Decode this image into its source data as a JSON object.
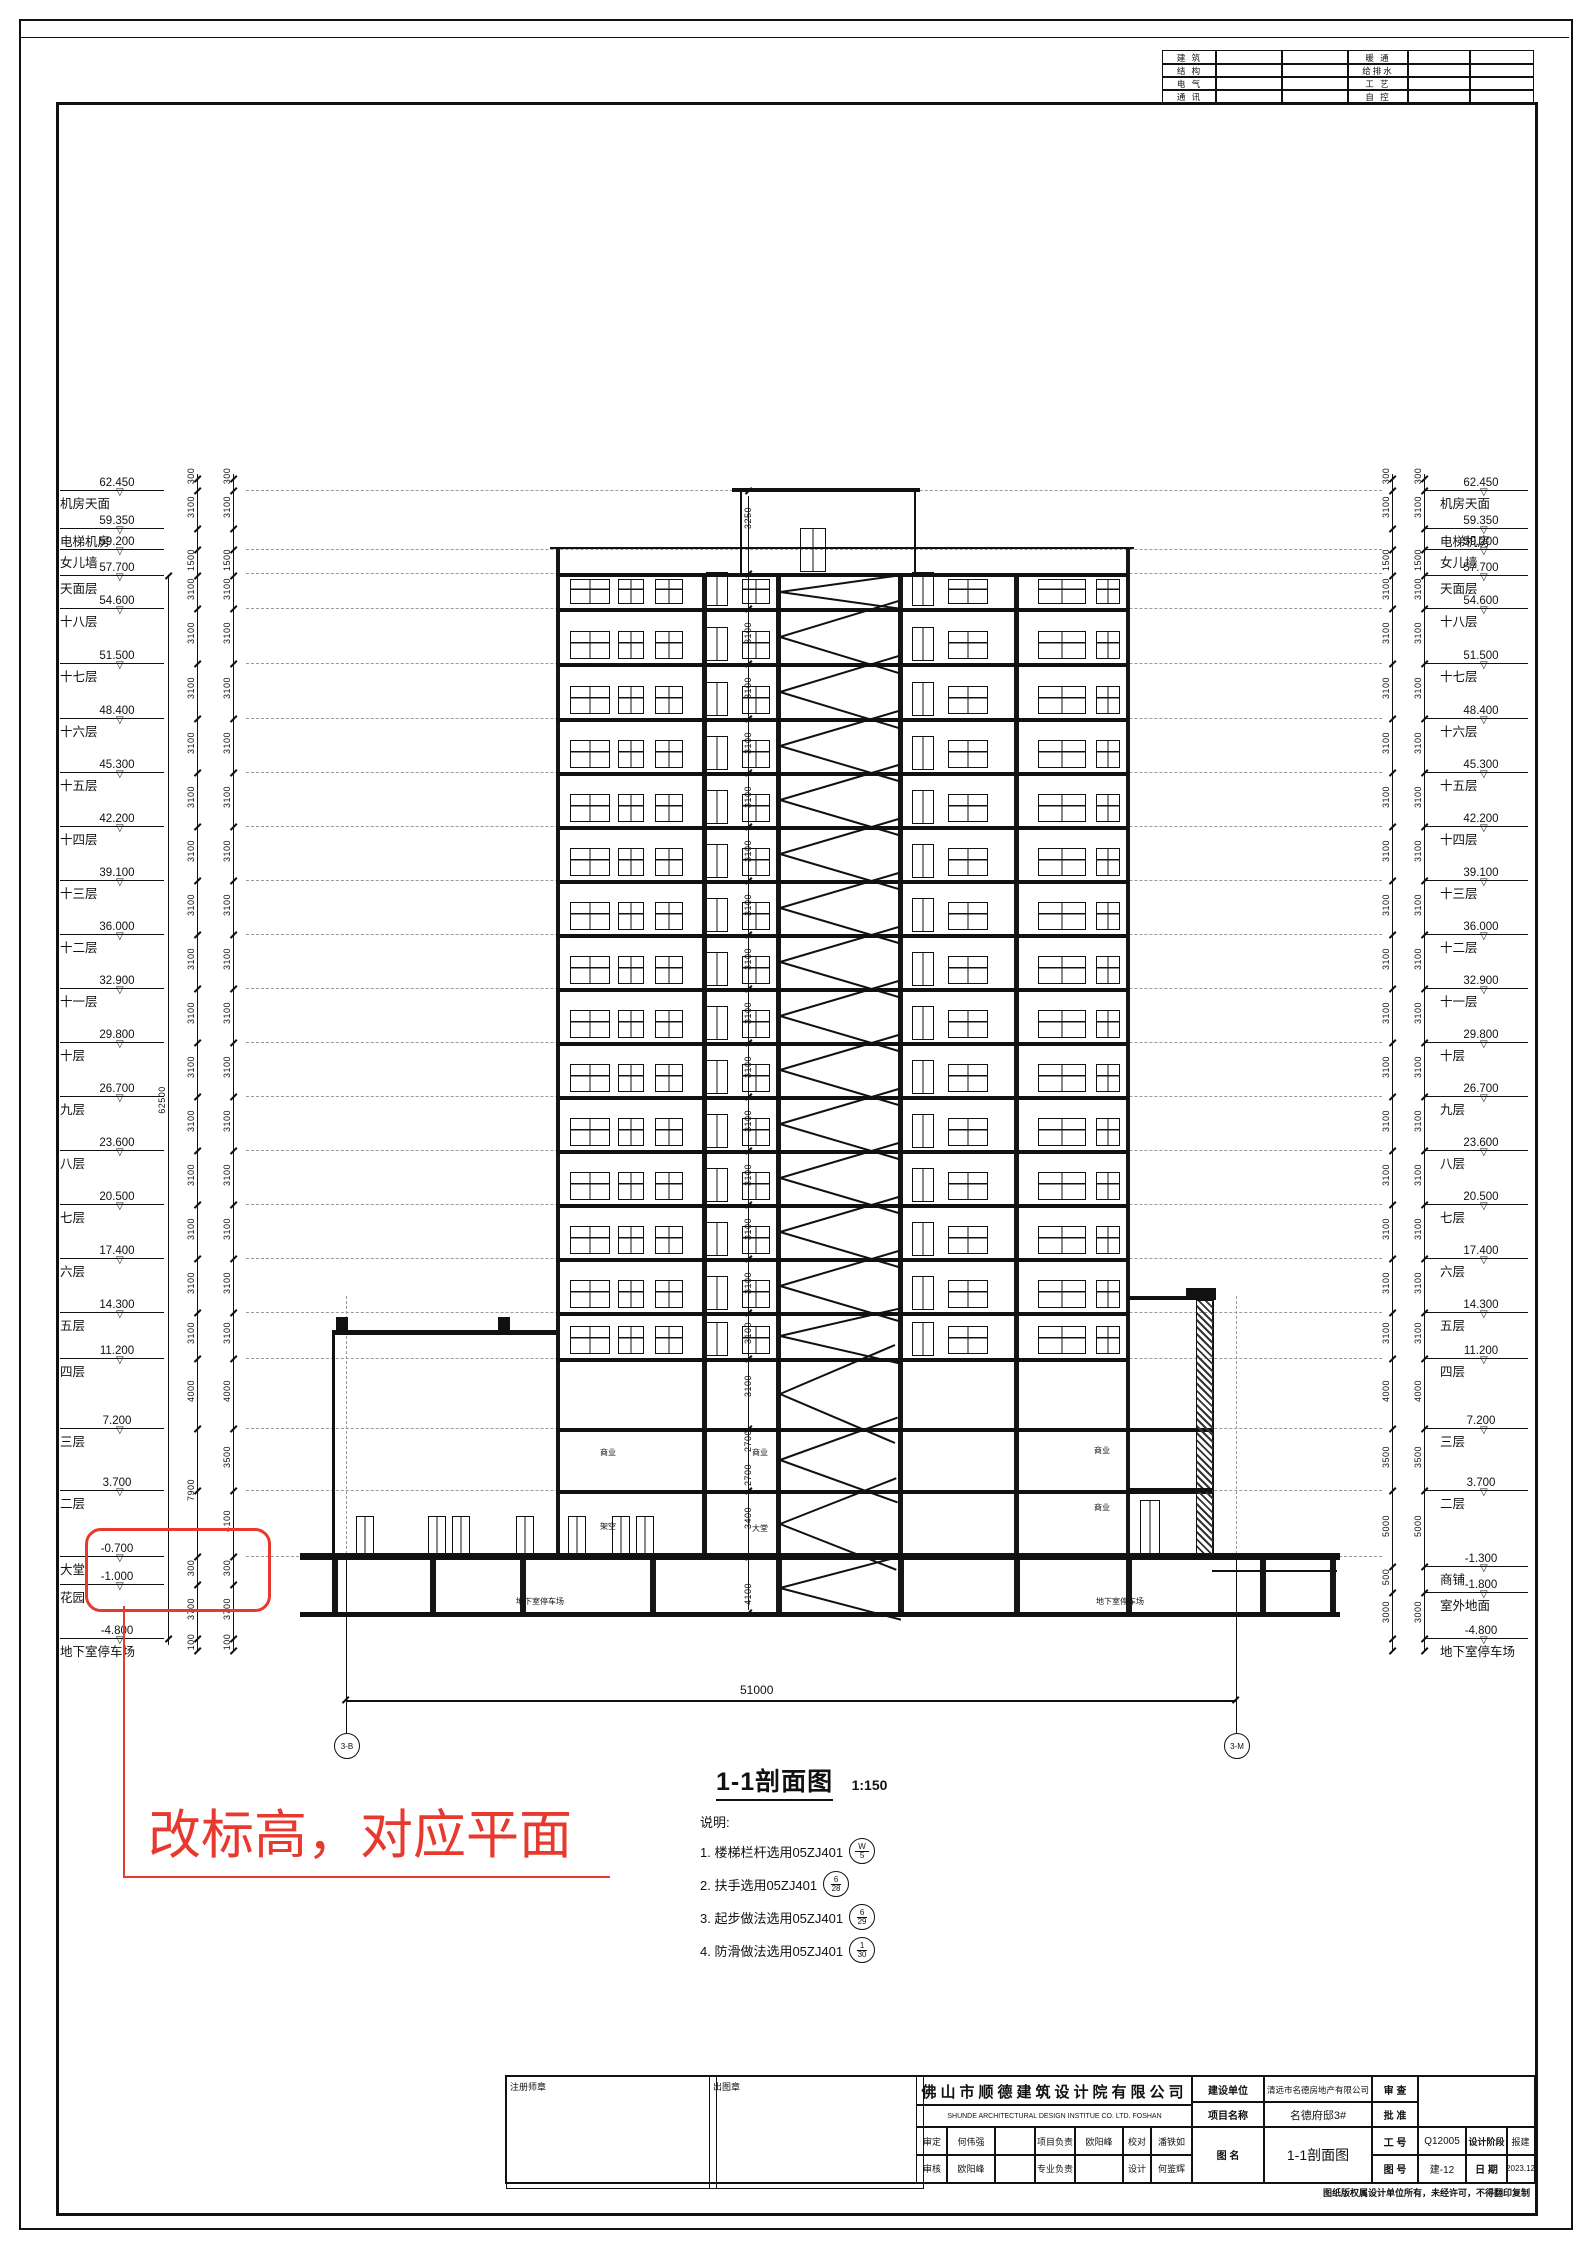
{
  "sheet": {
    "consultant_table": {
      "left_rows": [
        "建 筑",
        "结 构",
        "电 气",
        "通 讯"
      ],
      "right_rows": [
        "暖 通",
        "给排水",
        "工 艺",
        "自 控"
      ]
    },
    "caption": {
      "title": "1-1剖面图",
      "scale": "1:150"
    },
    "notes": {
      "heading": "说明:",
      "items": [
        {
          "text": "1. 楼梯栏杆选用05ZJ401",
          "num": "W",
          "den": "5"
        },
        {
          "text": "2. 扶手选用05ZJ401",
          "num": "6",
          "den": "28"
        },
        {
          "text": "3. 起步做法选用05ZJ401",
          "num": "6",
          "den": "29"
        },
        {
          "text": "4. 防滑做法选用05ZJ401",
          "num": "1",
          "den": "30"
        }
      ]
    },
    "revision": {
      "text": "改标高，对应平面",
      "color": "#e8392f"
    },
    "axes": {
      "dim_total": "51000",
      "left_bubble": "3-B",
      "right_bubble": "3-M"
    },
    "title_block": {
      "seal_left": "注册师章",
      "seal_right": "出图章",
      "company_cn": "佛山市顺德建筑设计院有限公司",
      "company_en": "SHUNDE  ARCHITECTURAL  DESIGN  INSTITUE  CO. LTD.   FOSHAN",
      "row1": [
        "审定",
        "何伟强",
        "",
        "项目负责",
        "欧阳峰",
        "校对",
        "潘铁如"
      ],
      "row2": [
        "审核",
        "欧阳峰",
        "",
        "专业负责",
        "",
        "设计",
        "何鉴辉"
      ],
      "client_label": "建设单位",
      "client": "清远市名德房地产有限公司",
      "project_label": "项目名称",
      "project": "名德府邸3#",
      "drawing_label": "图 名",
      "drawing_title": "1-1剖面图",
      "review_label": "审 查",
      "approve_label": "批 准",
      "job_label": "工 号",
      "job_no": "Q12005",
      "stage_label": "设计阶段",
      "stage": "报建",
      "sheet_label": "图 号",
      "sheet_no": "建-12",
      "date_label": "日 期",
      "date": "2023.12",
      "copyright": "图纸版权属设计单位所有，未经许可，不得翻印复制"
    }
  },
  "levels": {
    "left": [
      {
        "name": "机房天面",
        "elev": "62.450",
        "y": 490
      },
      {
        "name": "电梯机房",
        "elev": "59.350",
        "y": 528
      },
      {
        "name": "女儿墙",
        "elev": "59.200",
        "y": 549
      },
      {
        "name": "天面层",
        "elev": "57.700",
        "y": 575
      },
      {
        "name": "十八层",
        "elev": "54.600",
        "y": 608
      },
      {
        "name": "十七层",
        "elev": "51.500",
        "y": 663
      },
      {
        "name": "十六层",
        "elev": "48.400",
        "y": 718
      },
      {
        "name": "十五层",
        "elev": "45.300",
        "y": 772
      },
      {
        "name": "十四层",
        "elev": "42.200",
        "y": 826
      },
      {
        "name": "十三层",
        "elev": "39.100",
        "y": 880
      },
      {
        "name": "十二层",
        "elev": "36.000",
        "y": 934
      },
      {
        "name": "十一层",
        "elev": "32.900",
        "y": 988
      },
      {
        "name": "十层",
        "elev": "29.800",
        "y": 1042
      },
      {
        "name": "九层",
        "elev": "26.700",
        "y": 1096
      },
      {
        "name": "八层",
        "elev": "23.600",
        "y": 1150
      },
      {
        "name": "七层",
        "elev": "20.500",
        "y": 1204
      },
      {
        "name": "六层",
        "elev": "17.400",
        "y": 1258
      },
      {
        "name": "五层",
        "elev": "14.300",
        "y": 1312
      },
      {
        "name": "四层",
        "elev": "11.200",
        "y": 1358
      },
      {
        "name": "三层",
        "elev": "7.200",
        "y": 1428
      },
      {
        "name": "二层",
        "elev": "3.700",
        "y": 1490
      },
      {
        "name": "大堂",
        "elev": "-0.700",
        "y": 1556
      },
      {
        "name": "花园",
        "elev": "-1.000",
        "y": 1584
      },
      {
        "name": "地下室停车场",
        "elev": "-4.800",
        "y": 1638
      }
    ],
    "right": [
      {
        "name": "机房天面",
        "elev": "62.450",
        "y": 490
      },
      {
        "name": "电梯机房",
        "elev": "59.350",
        "y": 528
      },
      {
        "name": "女儿墙",
        "elev": "59.200",
        "y": 549
      },
      {
        "name": "天面层",
        "elev": "57.700",
        "y": 575
      },
      {
        "name": "十八层",
        "elev": "54.600",
        "y": 608
      },
      {
        "name": "十七层",
        "elev": "51.500",
        "y": 663
      },
      {
        "name": "十六层",
        "elev": "48.400",
        "y": 718
      },
      {
        "name": "十五层",
        "elev": "45.300",
        "y": 772
      },
      {
        "name": "十四层",
        "elev": "42.200",
        "y": 826
      },
      {
        "name": "十三层",
        "elev": "39.100",
        "y": 880
      },
      {
        "name": "十二层",
        "elev": "36.000",
        "y": 934
      },
      {
        "name": "十一层",
        "elev": "32.900",
        "y": 988
      },
      {
        "name": "十层",
        "elev": "29.800",
        "y": 1042
      },
      {
        "name": "九层",
        "elev": "26.700",
        "y": 1096
      },
      {
        "name": "八层",
        "elev": "23.600",
        "y": 1150
      },
      {
        "name": "七层",
        "elev": "20.500",
        "y": 1204
      },
      {
        "name": "六层",
        "elev": "17.400",
        "y": 1258
      },
      {
        "name": "五层",
        "elev": "14.300",
        "y": 1312
      },
      {
        "name": "四层",
        "elev": "11.200",
        "y": 1358
      },
      {
        "name": "三层",
        "elev": "7.200",
        "y": 1428
      },
      {
        "name": "二层",
        "elev": "3.700",
        "y": 1490
      },
      {
        "name": "商铺",
        "elev": "-1.300",
        "y": 1566
      },
      {
        "name": "室外地面",
        "elev": "-1.800",
        "y": 1592
      },
      {
        "name": "地下室停车场",
        "elev": "-4.800",
        "y": 1638
      }
    ]
  },
  "dims": {
    "overall_left": {
      "t": "62500",
      "y": 1095
    },
    "left_col1": [
      {
        "y": 478,
        "t": "300"
      },
      {
        "y": 509,
        "t": "3100"
      },
      {
        "y": 562,
        "t": "1500"
      },
      {
        "y": 591,
        "t": "3100"
      },
      {
        "y": 635,
        "t": "3100"
      },
      {
        "y": 690,
        "t": "3100"
      },
      {
        "y": 745,
        "t": "3100"
      },
      {
        "y": 799,
        "t": "3100"
      },
      {
        "y": 853,
        "t": "3100"
      },
      {
        "y": 907,
        "t": "3100"
      },
      {
        "y": 961,
        "t": "3100"
      },
      {
        "y": 1015,
        "t": "3100"
      },
      {
        "y": 1069,
        "t": "3100"
      },
      {
        "y": 1123,
        "t": "3100"
      },
      {
        "y": 1177,
        "t": "3100"
      },
      {
        "y": 1231,
        "t": "3100"
      },
      {
        "y": 1285,
        "t": "3100"
      },
      {
        "y": 1335,
        "t": "3100"
      },
      {
        "y": 1393,
        "t": "4000"
      },
      {
        "y": 1492,
        "t": "7900"
      },
      {
        "y": 1570,
        "t": "300"
      },
      {
        "y": 1611,
        "t": "3700"
      },
      {
        "y": 1644,
        "t": "100"
      }
    ],
    "left_col2": [
      {
        "y": 478,
        "t": "300"
      },
      {
        "y": 509,
        "t": "3100"
      },
      {
        "y": 562,
        "t": "1500"
      },
      {
        "y": 591,
        "t": "3100"
      },
      {
        "y": 635,
        "t": "3100"
      },
      {
        "y": 690,
        "t": "3100"
      },
      {
        "y": 745,
        "t": "3100"
      },
      {
        "y": 799,
        "t": "3100"
      },
      {
        "y": 853,
        "t": "3100"
      },
      {
        "y": 907,
        "t": "3100"
      },
      {
        "y": 961,
        "t": "3100"
      },
      {
        "y": 1015,
        "t": "3100"
      },
      {
        "y": 1069,
        "t": "3100"
      },
      {
        "y": 1123,
        "t": "3100"
      },
      {
        "y": 1177,
        "t": "3100"
      },
      {
        "y": 1231,
        "t": "3100"
      },
      {
        "y": 1285,
        "t": "3100"
      },
      {
        "y": 1335,
        "t": "3100"
      },
      {
        "y": 1393,
        "t": "4000"
      },
      {
        "y": 1459,
        "t": "3500"
      },
      {
        "y": 1523,
        "t": "4100"
      },
      {
        "y": 1570,
        "t": "300"
      },
      {
        "y": 1611,
        "t": "3700"
      },
      {
        "y": 1644,
        "t": "100"
      }
    ],
    "right_col1": [
      {
        "y": 478,
        "t": "300"
      },
      {
        "y": 509,
        "t": "3100"
      },
      {
        "y": 562,
        "t": "1500"
      },
      {
        "y": 591,
        "t": "3100"
      },
      {
        "y": 635,
        "t": "3100"
      },
      {
        "y": 690,
        "t": "3100"
      },
      {
        "y": 745,
        "t": "3100"
      },
      {
        "y": 799,
        "t": "3100"
      },
      {
        "y": 853,
        "t": "3100"
      },
      {
        "y": 907,
        "t": "3100"
      },
      {
        "y": 961,
        "t": "3100"
      },
      {
        "y": 1015,
        "t": "3100"
      },
      {
        "y": 1069,
        "t": "3100"
      },
      {
        "y": 1123,
        "t": "3100"
      },
      {
        "y": 1177,
        "t": "3100"
      },
      {
        "y": 1231,
        "t": "3100"
      },
      {
        "y": 1285,
        "t": "3100"
      },
      {
        "y": 1335,
        "t": "3100"
      },
      {
        "y": 1393,
        "t": "4000"
      },
      {
        "y": 1459,
        "t": "3500"
      },
      {
        "y": 1528,
        "t": "5000"
      },
      {
        "y": 1579,
        "t": "500"
      },
      {
        "y": 1614,
        "t": "3000"
      }
    ],
    "right_col2": [
      {
        "y": 478,
        "t": "300"
      },
      {
        "y": 509,
        "t": "3100"
      },
      {
        "y": 562,
        "t": "1500"
      },
      {
        "y": 591,
        "t": "3100"
      },
      {
        "y": 635,
        "t": "3100"
      },
      {
        "y": 690,
        "t": "3100"
      },
      {
        "y": 745,
        "t": "3100"
      },
      {
        "y": 799,
        "t": "3100"
      },
      {
        "y": 853,
        "t": "3100"
      },
      {
        "y": 907,
        "t": "3100"
      },
      {
        "y": 961,
        "t": "3100"
      },
      {
        "y": 1015,
        "t": "3100"
      },
      {
        "y": 1069,
        "t": "3100"
      },
      {
        "y": 1123,
        "t": "3100"
      },
      {
        "y": 1177,
        "t": "3100"
      },
      {
        "y": 1231,
        "t": "3100"
      },
      {
        "y": 1285,
        "t": "3100"
      },
      {
        "y": 1335,
        "t": "3100"
      },
      {
        "y": 1393,
        "t": "4000"
      },
      {
        "y": 1459,
        "t": "3500"
      },
      {
        "y": 1528,
        "t": "5000"
      },
      {
        "y": 1614,
        "t": "3000"
      }
    ],
    "center": [
      {
        "y": 520,
        "t": "3250"
      },
      {
        "y": 635,
        "t": "3100"
      },
      {
        "y": 690,
        "t": "3100"
      },
      {
        "y": 745,
        "t": "3100"
      },
      {
        "y": 799,
        "t": "3100"
      },
      {
        "y": 853,
        "t": "3100"
      },
      {
        "y": 907,
        "t": "3100"
      },
      {
        "y": 961,
        "t": "3100"
      },
      {
        "y": 1015,
        "t": "3100"
      },
      {
        "y": 1069,
        "t": "3100"
      },
      {
        "y": 1123,
        "t": "3100"
      },
      {
        "y": 1177,
        "t": "3100"
      },
      {
        "y": 1231,
        "t": "3100"
      },
      {
        "y": 1285,
        "t": "3100"
      },
      {
        "y": 1335,
        "t": "3100"
      },
      {
        "y": 1388,
        "t": "3100"
      },
      {
        "y": 1443,
        "t": "2700"
      },
      {
        "y": 1477,
        "t": "2700"
      },
      {
        "y": 1520,
        "t": "3400"
      },
      {
        "y": 1596,
        "t": "4100"
      }
    ]
  },
  "rooms": [
    {
      "t": "商业",
      "x": 600,
      "y": 1447
    },
    {
      "t": "商业",
      "x": 752,
      "y": 1447
    },
    {
      "t": "商业",
      "x": 1094,
      "y": 1445
    },
    {
      "t": "商业",
      "x": 1094,
      "y": 1502
    },
    {
      "t": "架空",
      "x": 600,
      "y": 1521
    },
    {
      "t": "大堂",
      "x": 752,
      "y": 1523
    },
    {
      "t": "地下室停车场",
      "x": 516,
      "y": 1596
    },
    {
      "t": "地下室停车场",
      "x": 1096,
      "y": 1596
    }
  ]
}
